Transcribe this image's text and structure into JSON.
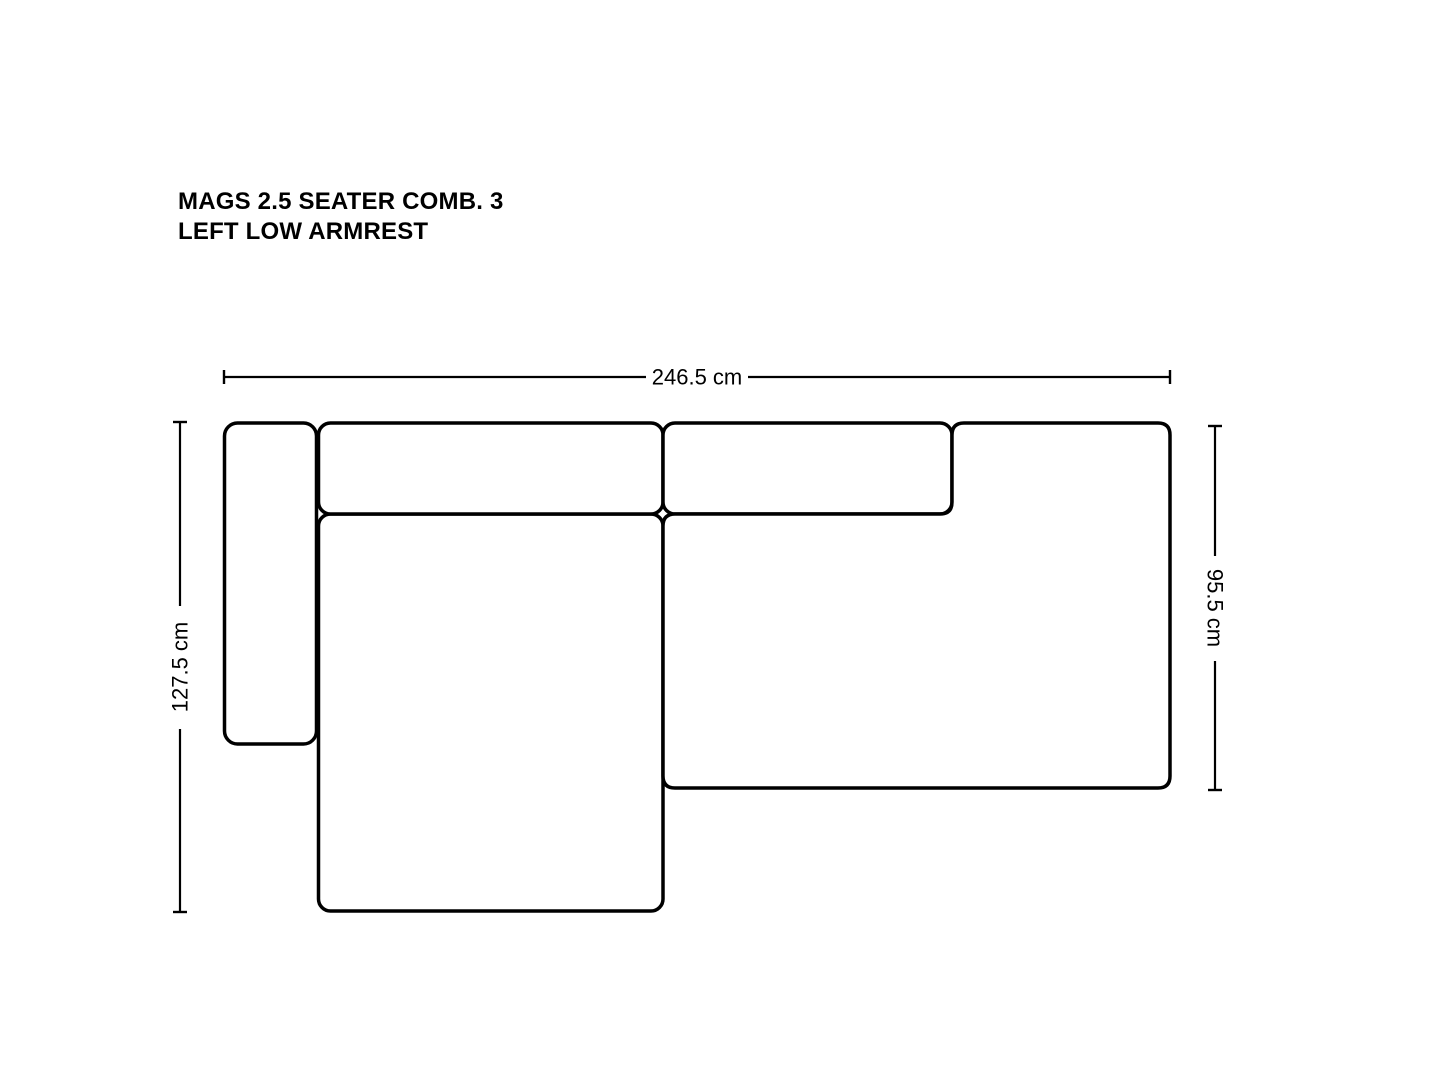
{
  "title": {
    "line1": "MAGS 2.5 SEATER COMB. 3",
    "line2": "LEFT LOW ARMREST"
  },
  "dimensions": {
    "overall_width": "246.5 cm",
    "overall_depth": "127.5 cm",
    "seat_depth": "95.5 cm"
  },
  "colors": {
    "background": "#ffffff",
    "outline": "#000000",
    "text": "#000000"
  }
}
